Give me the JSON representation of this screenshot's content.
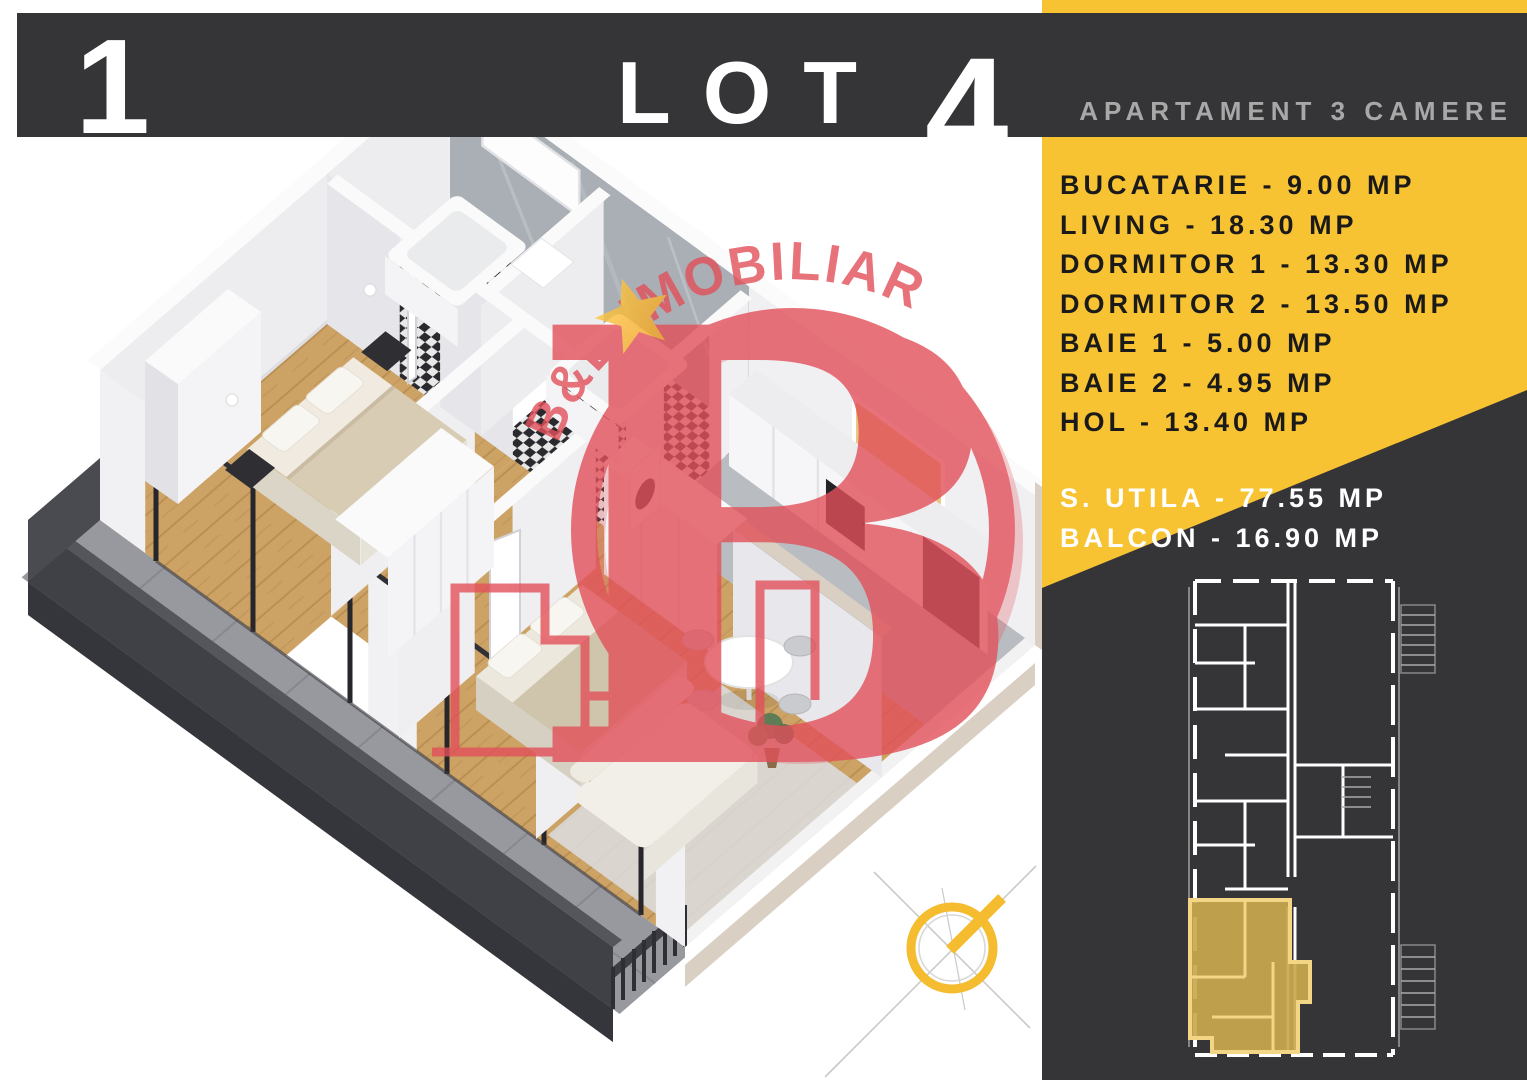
{
  "header": {
    "index_number": "1",
    "lot_label": "LOT",
    "lot_number": "4",
    "subtitle": "APARTAMENT 3 CAMERE"
  },
  "sidebar": {
    "room_lines": [
      "BUCATARIE - 9.00 MP",
      "LIVING - 18.30 MP",
      "DORMITOR 1 - 13.30 MP",
      "DORMITOR 2 - 13.50 MP",
      "BAIE 1 - 5.00 MP",
      "BAIE 2 - 4.95 MP",
      "HOL - 13.40 MP"
    ],
    "summary_lines": [
      "S. UTILA - 77.55 MP",
      "BALCON - 16.90 MP"
    ]
  },
  "watermark": {
    "brand": "B&B IMOBILIARE",
    "emblem_letter": "B"
  },
  "colors": {
    "accent_yellow": "#F8C333",
    "panel_dark": "#353538",
    "watermark_red": "#E2505A",
    "minimap_highlight": "#C9A84E",
    "wood_floor": "#CDA365",
    "balcony_dark": "#404147"
  }
}
